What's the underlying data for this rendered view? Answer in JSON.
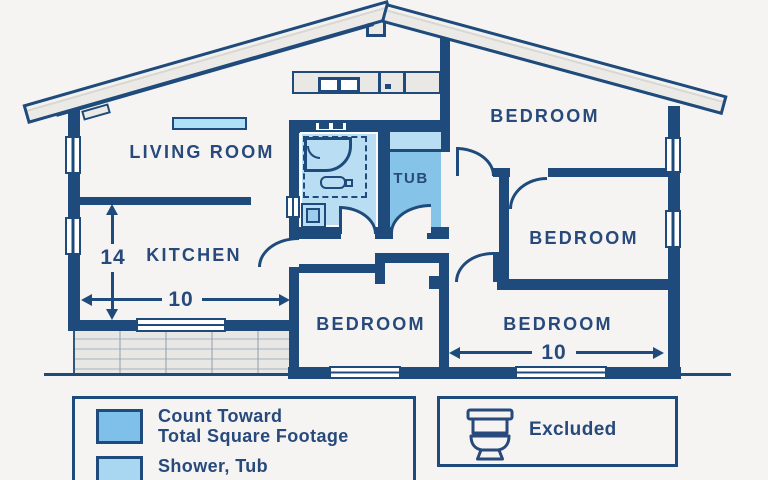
{
  "rooms": {
    "living_room": "LIVING ROOM",
    "kitchen": "KITCHEN",
    "tub": "TUB",
    "bedroom_top_right": "BEDROOM",
    "bedroom_middle_right": "BEDROOM",
    "bedroom_bottom_center": "BEDROOM",
    "bedroom_bottom_right": "BEDROOM"
  },
  "dimensions": {
    "kitchen_depth": "14",
    "kitchen_width": "10",
    "bedroom_width": "10"
  },
  "legend": {
    "counted": {
      "line1": "Count Toward",
      "line2": "Total Square Footage",
      "swatch_color": "#7fc0ea"
    },
    "shower_tub": {
      "label": "Shower, Tub",
      "swatch_color": "#a9d6f0"
    },
    "excluded": {
      "label": "Excluded",
      "icon": "toilet-icon"
    }
  },
  "colors": {
    "wall_navy": "#1e4b7b",
    "text_navy": "#27497b",
    "room_fill_light": "#b9ddf2",
    "room_fill_medium": "#85c3e9",
    "roof_gray": "#ebeae6",
    "background": "#f5f4f2"
  }
}
